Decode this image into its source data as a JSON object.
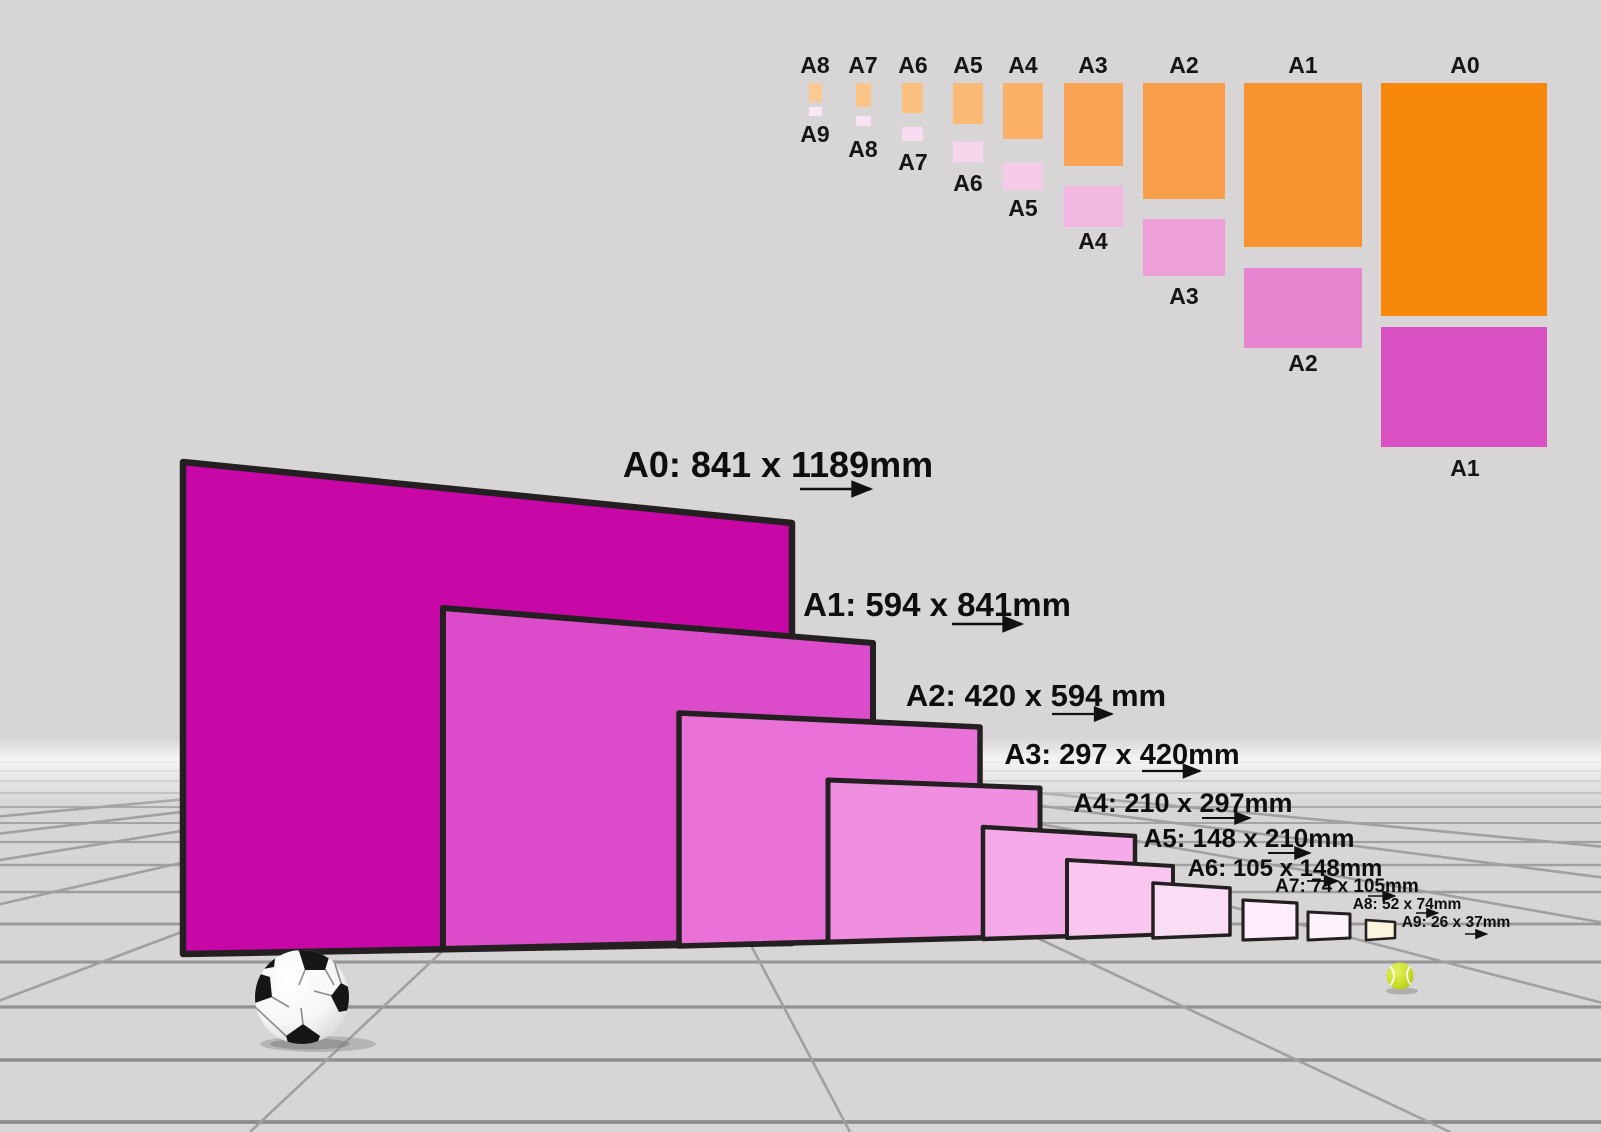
{
  "scene": {
    "background_color": "#d7d5d5",
    "grid_line_color": "#a29fa0",
    "sheet_border_color": "#242021",
    "arrow_color": "#111111",
    "tennis_ball_color": "#c9dc26",
    "soccer_ball_dark": "#141414"
  },
  "size_chart": {
    "columns": [
      {
        "top_label": "A8",
        "bottom_label": "A9",
        "orange_color": "#fbca92",
        "pink_color": "#fae9f4"
      },
      {
        "top_label": "A7",
        "bottom_label": "A8",
        "orange_color": "#fbc58a",
        "pink_color": "#f9e3f2"
      },
      {
        "top_label": "A6",
        "bottom_label": "A7",
        "orange_color": "#fbc080",
        "pink_color": "#f8dcef"
      },
      {
        "top_label": "A5",
        "bottom_label": "A6",
        "orange_color": "#fab974",
        "pink_color": "#f7d5ec"
      },
      {
        "top_label": "A4",
        "bottom_label": "A5",
        "orange_color": "#fab066",
        "pink_color": "#f5cbe8"
      },
      {
        "top_label": "A3",
        "bottom_label": "A4",
        "orange_color": "#f9a455",
        "pink_color": "#f3b8e1"
      },
      {
        "top_label": "A2",
        "bottom_label": "A3",
        "orange_color": "#f99e49",
        "pink_color": "#ed9fd8"
      },
      {
        "top_label": "A1",
        "bottom_label": "A2",
        "orange_color": "#f89430",
        "pink_color": "#e685d0"
      },
      {
        "top_label": "A0",
        "bottom_label": "A1",
        "orange_color": "#f68708",
        "pink_color": "#d850c2"
      }
    ]
  },
  "sheets": [
    {
      "name": "A0",
      "label": "A0: 841 x 1189mm",
      "fill": "#c808a6"
    },
    {
      "name": "A1",
      "label": "A1: 594 x 841mm",
      "fill": "#dc4bc9"
    },
    {
      "name": "A2",
      "label": "A2: 420 x 594 mm",
      "fill": "#e971d8"
    },
    {
      "name": "A3",
      "label": "A3: 297 x 420mm",
      "fill": "#f08fe0"
    },
    {
      "name": "A4",
      "label": "A4: 210 x 297mm",
      "fill": "#f5abe9"
    },
    {
      "name": "A5",
      "label": "A5: 148 x 210mm",
      "fill": "#f9c6f0"
    },
    {
      "name": "A6",
      "label": "A6: 105 x 148mm",
      "fill": "#fbdcf5"
    },
    {
      "name": "A7",
      "label": "A7: 74 x 105mm",
      "fill": "#fdecf9"
    },
    {
      "name": "A8",
      "label": "A8: 52 x 74mm",
      "fill": "#fdf3fb"
    },
    {
      "name": "A9",
      "label": "A9: 26 x 37mm",
      "fill": "#fbf3dc"
    }
  ]
}
